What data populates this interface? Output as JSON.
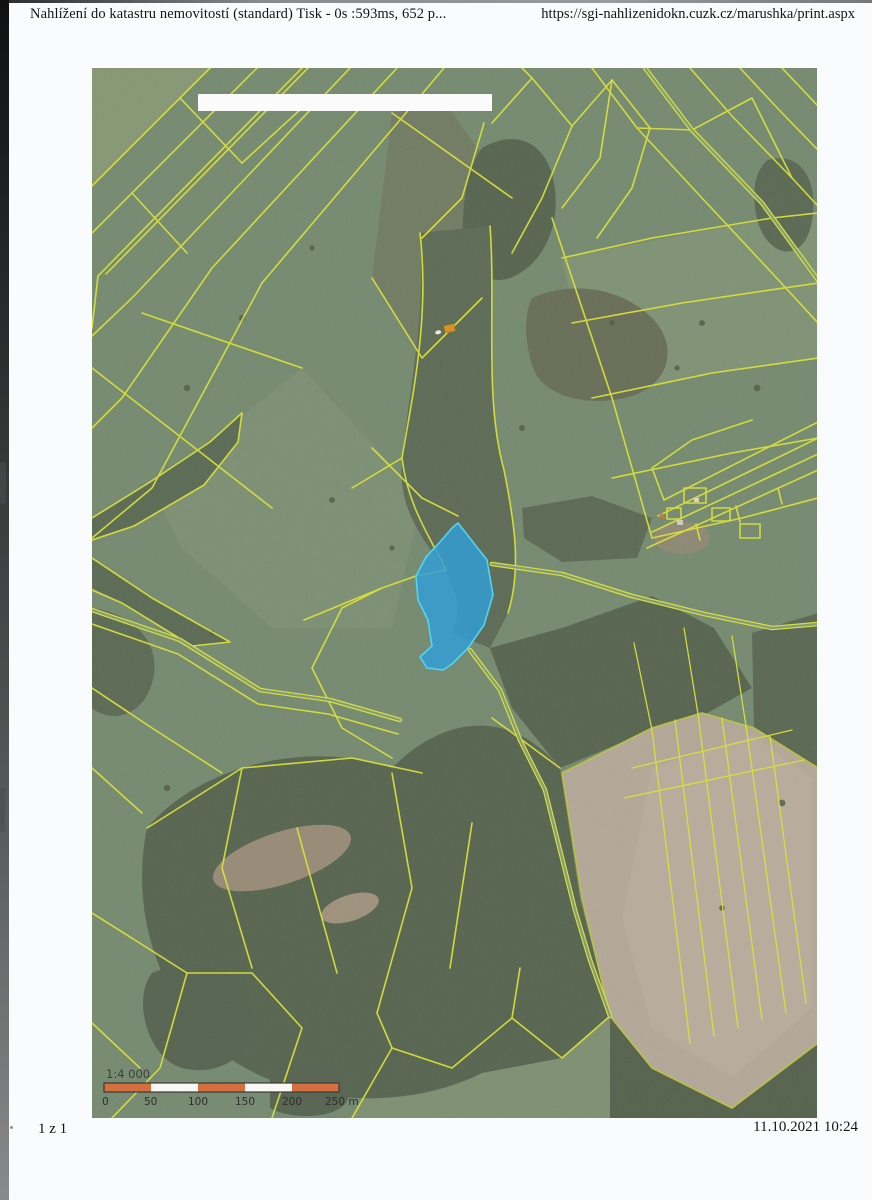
{
  "header": {
    "title": "Nahlížení do katastru nemovitostí (standard) Tisk - 0s :593ms, 652 p...",
    "url": "https://sgi-nahlizenidokn.cuzk.cz/marushka/print.aspx"
  },
  "footer": {
    "page_number": "1 z 1",
    "datetime": "11.10.2021 10:24"
  },
  "map": {
    "scalebar": {
      "ratio": "1:4 000",
      "ticks": [
        "0",
        "50",
        "100",
        "150",
        "200",
        "250 m"
      ],
      "segment_colors": [
        "#d4703f",
        "#f8f8f5",
        "#d4703f",
        "#f8f8f5",
        "#d4703f"
      ],
      "border_color": "#3a3a3a",
      "label_color": "#2e2e2e"
    },
    "colors": {
      "meadow": "#7e9878",
      "forest": "#57694f",
      "field_tan": "#cdbfa9",
      "parcel_line": "#d8e03a",
      "road_core": "#849b7c",
      "highlight_fill": "#2f9fd8",
      "highlight_stroke": "#52d4f0",
      "building": "#d98f2b",
      "redacted_box": "#fbfbfb"
    }
  }
}
